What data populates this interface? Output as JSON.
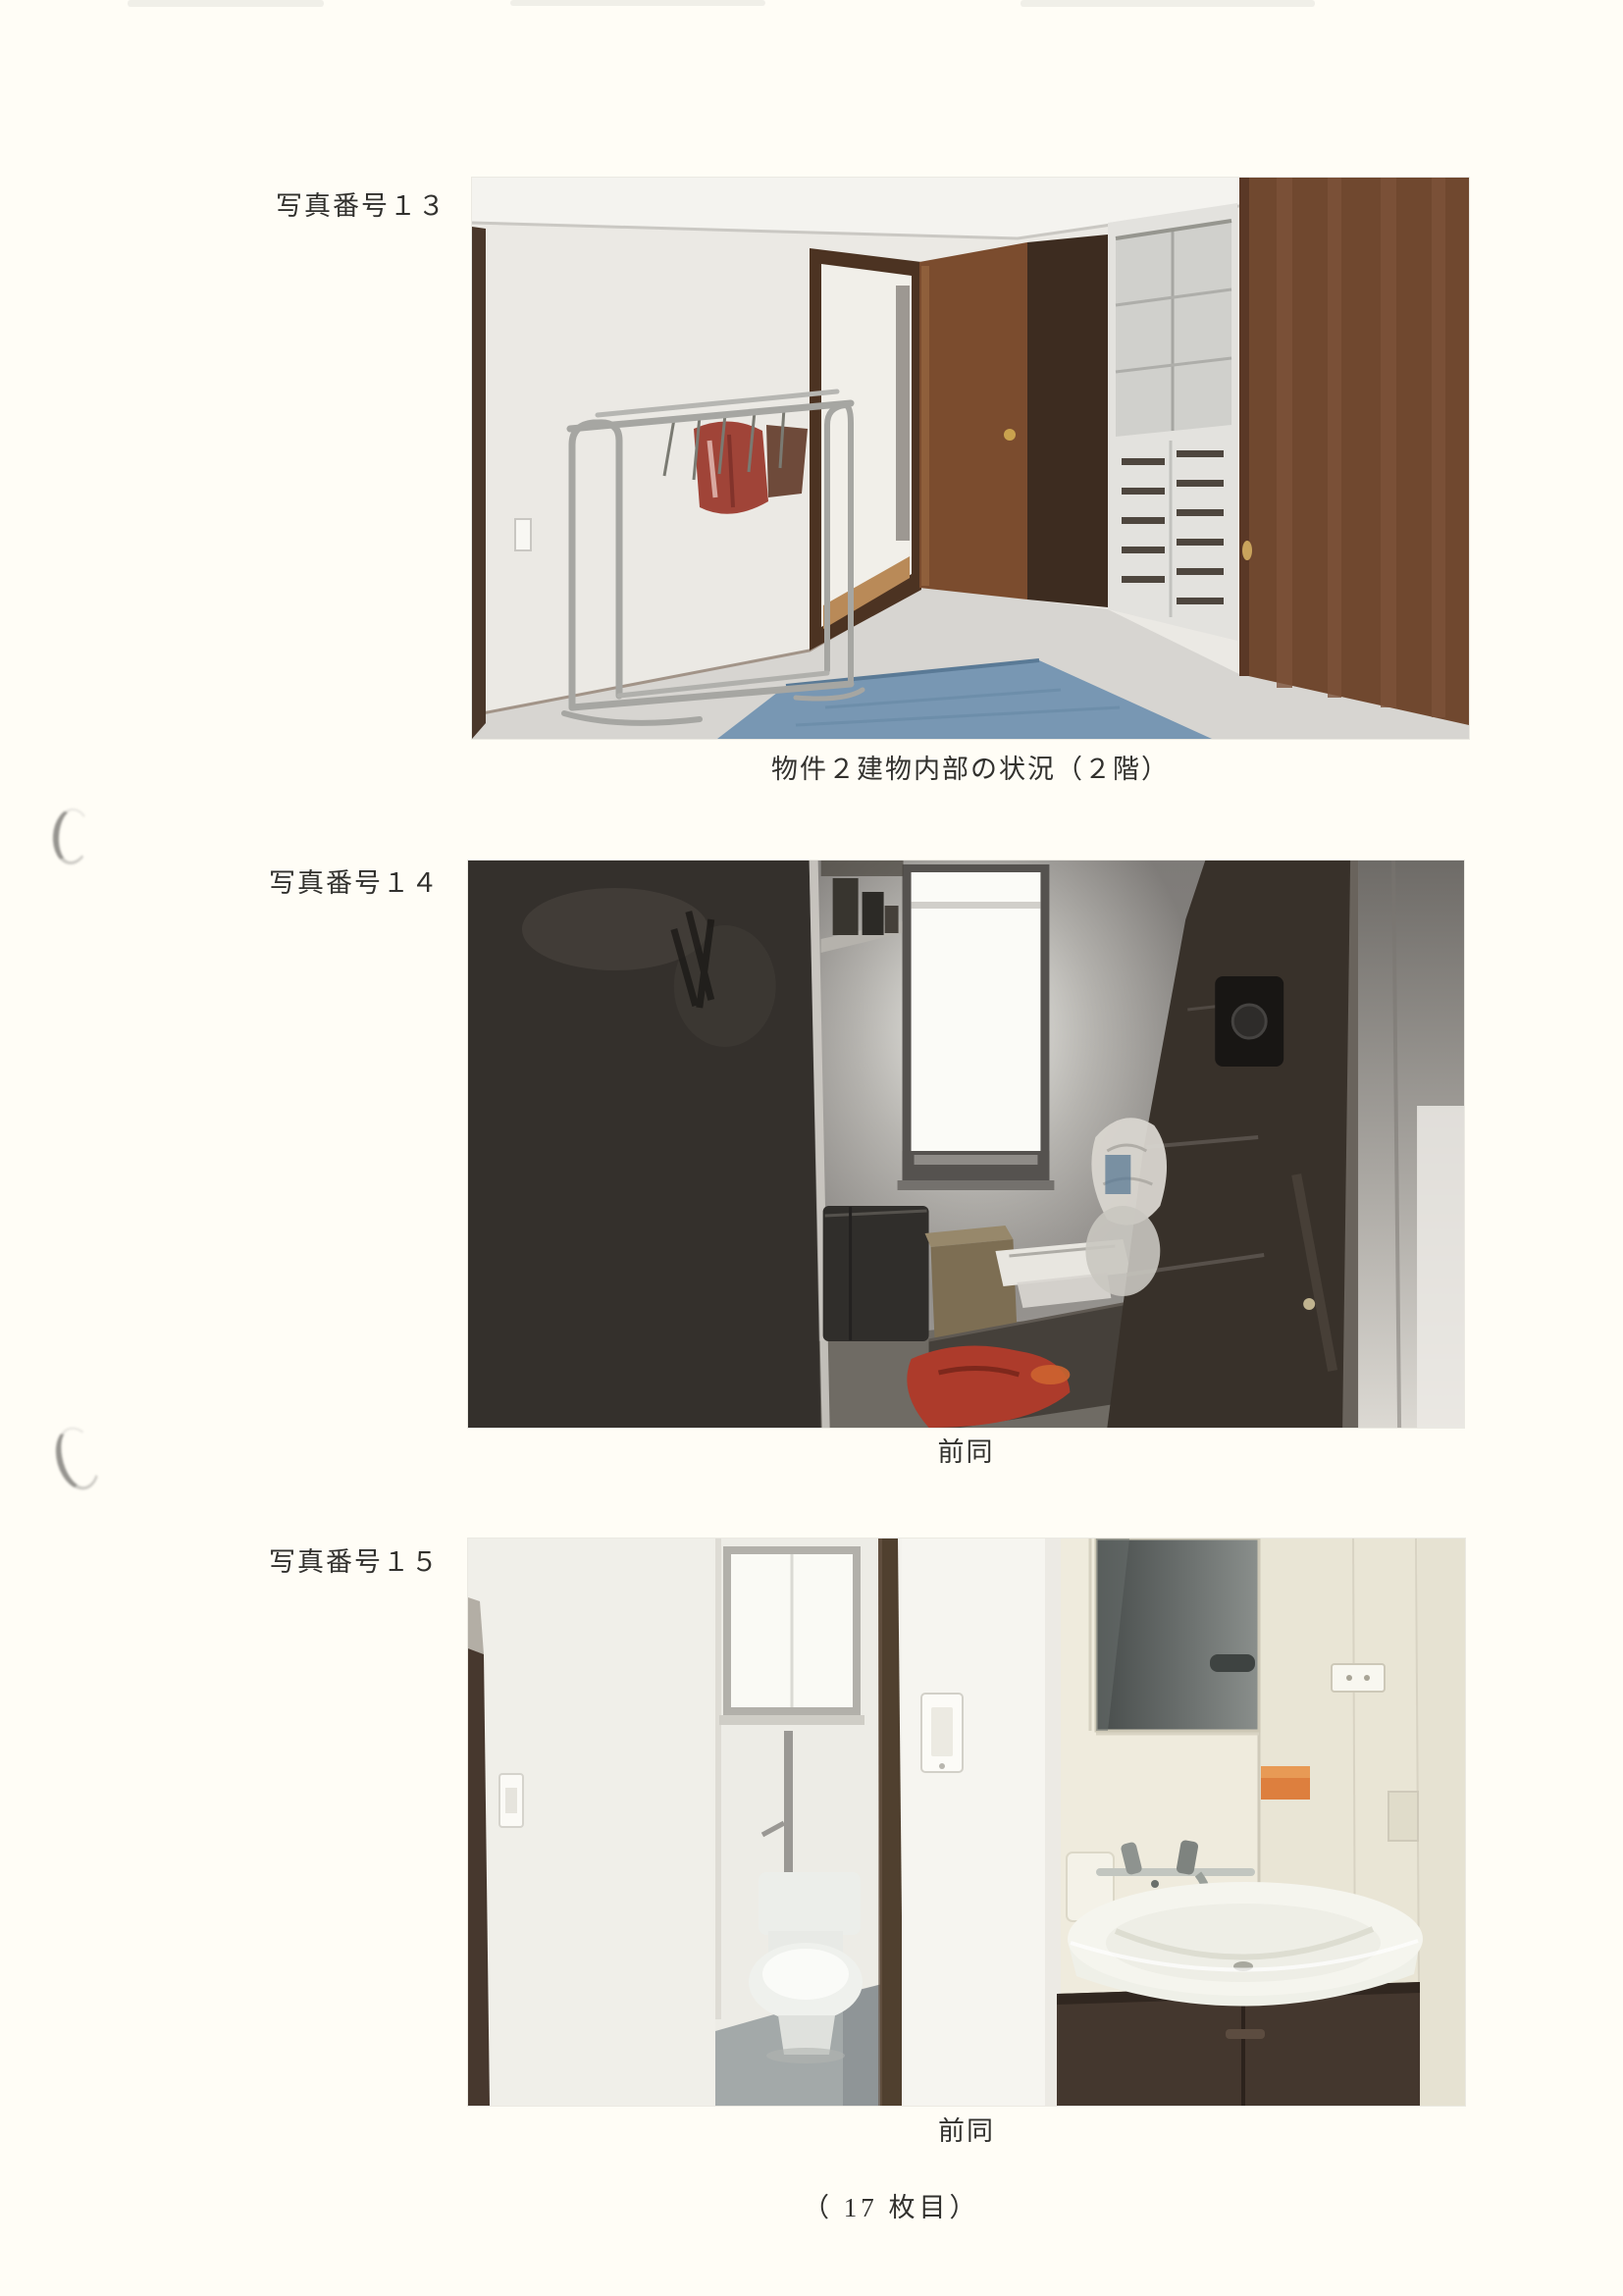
{
  "photos": [
    {
      "label": "写真番号１３",
      "caption": "物件２建物内部の状況（２階）",
      "alt": "洋室内部：白い壁とパイプハンガーラック、開いたドア、白い収納棚、茶色のクローゼット扉、青いラグ"
    },
    {
      "label": "写真番号１４",
      "caption": "前同",
      "alt": "暗い納戸：左に黒い家具、中央に明るい縦長の窓、手前に箱類と赤い布、右に茶色の棚"
    },
    {
      "label": "写真番号１５",
      "caption": "前同",
      "alt": "トイレと洗面化粧台：左にトイレ室、中央に白い間仕切り壁、右に鏡付き洗面台"
    }
  ],
  "footer": {
    "page_note": "（ 17 枚目）"
  }
}
